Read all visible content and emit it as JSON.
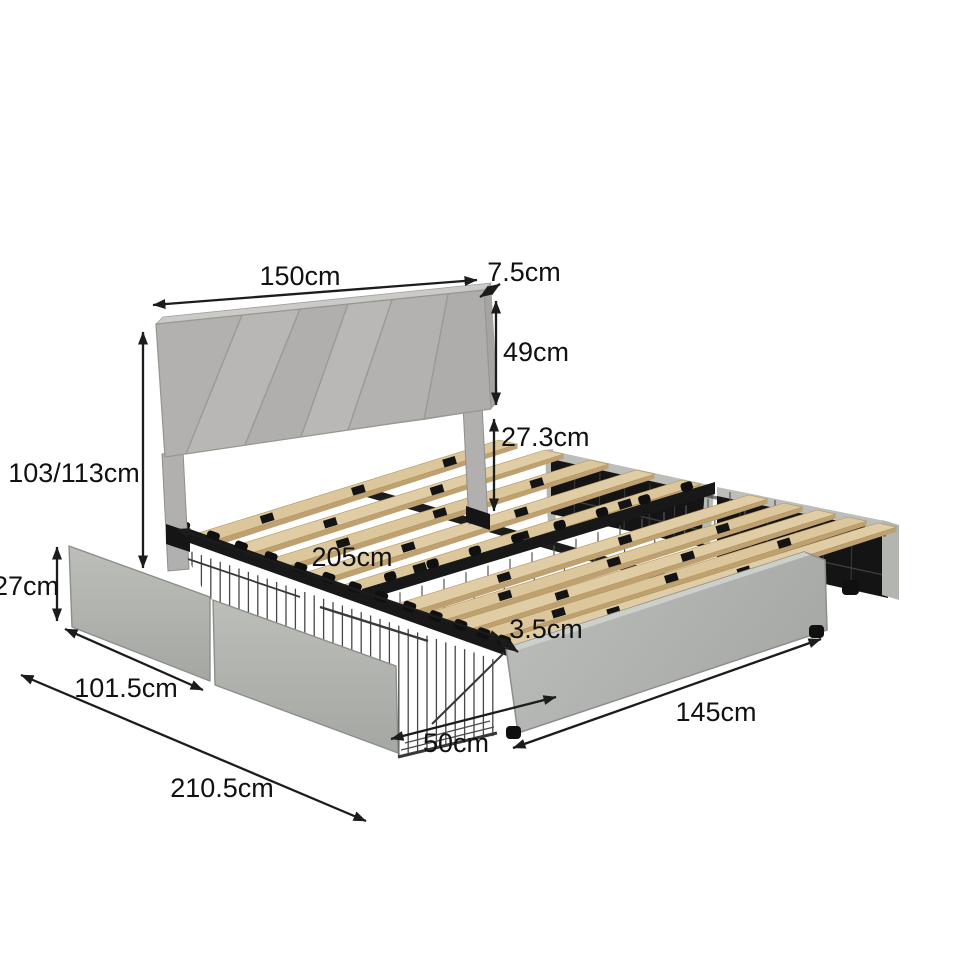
{
  "dimensions": {
    "headboard_width": {
      "label": "150cm"
    },
    "headboard_thickness": {
      "label": "7.5cm"
    },
    "headboard_height": {
      "label": "49cm"
    },
    "frame_clearance": {
      "label": "27.3cm"
    },
    "total_height": {
      "label": "103/113cm"
    },
    "bed_length": {
      "label": "205cm"
    },
    "drawer_height": {
      "label": "27cm"
    },
    "drawer_width": {
      "label": "101.5cm"
    },
    "slat_thickness": {
      "label": "3.5cm"
    },
    "drawer_depth": {
      "label": "50cm"
    },
    "footboard_width": {
      "label": "145cm"
    },
    "total_length": {
      "label": "210.5cm"
    }
  },
  "colors": {
    "background": "#ffffff",
    "upholstery": "#b5b4b2",
    "upholstery_light": "#cbcac8",
    "upholstery_dark": "#a5a4a2",
    "metal_black": "#181818",
    "slat_wood": "#dcc79c",
    "slat_edge": "#bfa171",
    "wire": "#4a4a4a",
    "dimension_ink": "#1c1c1c"
  }
}
